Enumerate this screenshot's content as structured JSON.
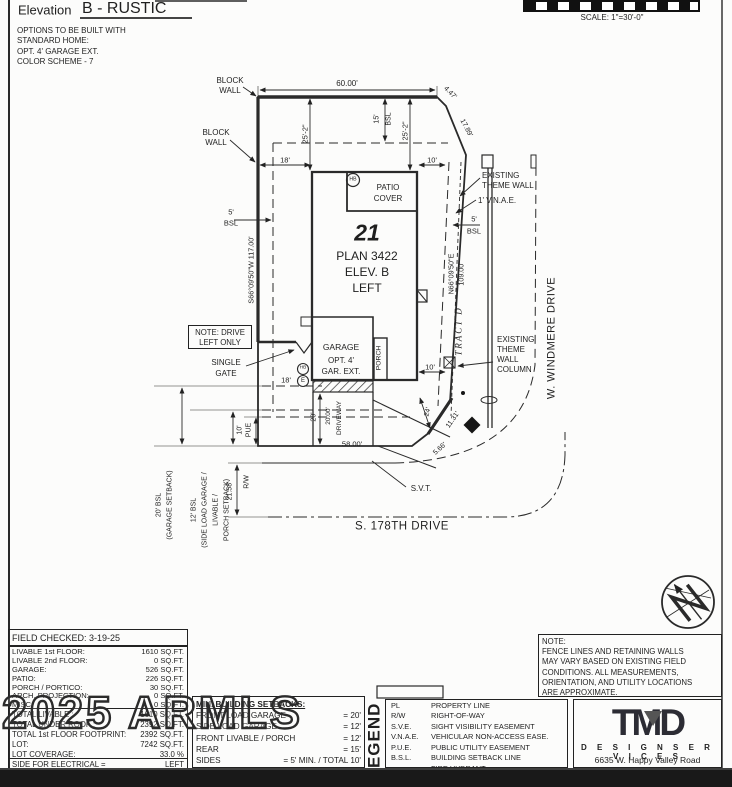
{
  "header": {
    "elevation_label": "Elevation",
    "elevation_value": "B - RUSTIC",
    "options": [
      "OPTIONS TO BE BUILT WITH",
      "STANDARD HOME:",
      "OPT. 4' GARAGE EXT.",
      "COLOR SCHEME - 7"
    ],
    "scale": "SCALE:  1\"=30'-0\""
  },
  "plan": {
    "block_wall_top": [
      "BLOCK",
      "WALL"
    ],
    "block_wall_left": [
      "BLOCK",
      "WALL"
    ],
    "dim_60": "60.00'",
    "dim_447": "4.47'",
    "dim_1789": "17.89'",
    "dim_252_left": "25'-2\"",
    "dim_252_right": "25'-2\"",
    "dim_15": "15'",
    "bsl_15": "BSL",
    "dim_18_top": "18'",
    "dim_10_top": "10'",
    "existing_theme_wall": [
      "EXISTING",
      "THEME WALL"
    ],
    "vnae": "1' V.N.A.E.",
    "dim_5_right": "5'",
    "bsl_right": "BSL",
    "bearing_right": "N66°09'50\"E",
    "dim_109": "109.00'",
    "tract_d": "TRACT  D",
    "bearing_left": "S66°09'50\"W  117.00'",
    "dim_5_left": "5'",
    "bsl_left": "BSL",
    "lot_number": "21",
    "plan_name": "PLAN 3422",
    "elev": "ELEV. B",
    "side": "LEFT",
    "patio_cover": [
      "PATIO",
      "COVER"
    ],
    "hb": "HB",
    "e": "E",
    "garage": "GARAGE",
    "garage_opt1": "OPT. 4'",
    "garage_opt2": "GAR. EXT.",
    "porch": "PORCH",
    "note_drive": [
      "NOTE: DRIVE",
      "LEFT ONLY"
    ],
    "single_gate": [
      "SINGLE",
      "GATE"
    ],
    "dim_18_gate": "18'",
    "theme_wall_column": [
      "EXISTING",
      "THEME",
      "WALL",
      "COLUMN"
    ],
    "dim_10_column": "10'",
    "windmere": "W. WINDMERE DRIVE",
    "dim_20": "20'",
    "dim_2000": "20.00'",
    "driveway": "DRIVEWAY",
    "dim_58": "58.00'",
    "dim_24": "24'",
    "dim_1131": "11.31'",
    "dim_566": "5.66'",
    "svt": "S.V.T.",
    "dim_10_pue": "10'",
    "pue": "PUE",
    "dim_2158": "21.58'",
    "rw": "R/W",
    "setback_20": [
      "20' BSL",
      "(GARAGE SETBACK)"
    ],
    "setback_12": [
      "12' BSL",
      "(SIDE LOAD GARAGE /",
      "LIVABLE /",
      "PORCH SETBACK)"
    ],
    "street": "S. 178TH DRIVE"
  },
  "areas": {
    "field_checked": "FIELD CHECKED:  3-19-25",
    "rows": [
      {
        "label": "LIVABLE 1st FLOOR:",
        "value": "1610 SQ.FT."
      },
      {
        "label": "LIVABLE 2nd FLOOR:",
        "value": "0 SQ.FT."
      },
      {
        "label": "GARAGE:",
        "value": "526 SQ.FT."
      },
      {
        "label": "PATIO:",
        "value": "226 SQ.FT."
      },
      {
        "label": "PORCH / PORTICO:",
        "value": "30 SQ.FT."
      },
      {
        "label": "ARCH. PROJECTION:",
        "value": "0 SQ.FT."
      },
      {
        "label": "MISC:",
        "value": "0 SQ.FT."
      }
    ],
    "totals": [
      {
        "label": "TOTAL LIVABLE :",
        "value": "1610 SQ.FT."
      },
      {
        "label": "TOTAL UNDER ROOF :",
        "value": "2392 SQ.FT."
      },
      {
        "label": "TOTAL 1st FLOOR FOOTPRINT:",
        "value": "2392 SQ.FT."
      },
      {
        "label": "LOT:",
        "value": "7242 SQ.FT."
      },
      {
        "label": "LOT COVERAGE:",
        "value": "33.0 %"
      }
    ],
    "electrical": {
      "label": "SIDE FOR ELECTRICAL =",
      "value": "LEFT"
    }
  },
  "setbacks": {
    "title": "MIN. BUILDING SETBACKS:",
    "rows": [
      {
        "label": "FRONT LOAD GARAGE",
        "value": "= 20'"
      },
      {
        "label": "SIDE LOAD GARAGE",
        "value": "= 12'"
      },
      {
        "label": "FRONT LIVABLE / PORCH",
        "value": "= 12'"
      },
      {
        "label": "REAR",
        "value": "= 15'"
      },
      {
        "label": "SIDES",
        "value": "= 5' MIN. / TOTAL 10'"
      }
    ]
  },
  "legend": {
    "title": "LEGEND",
    "rows": [
      {
        "symbol": "PL",
        "desc": "PROPERTY LINE"
      },
      {
        "symbol": "R/W",
        "desc": "RIGHT-OF-WAY"
      },
      {
        "symbol": "S.V.E.",
        "desc": "SIGHT VISIBILITY EASEMENT"
      },
      {
        "symbol": "V.N.A.E.",
        "desc": "VEHICULAR NON-ACCESS EASE."
      },
      {
        "symbol": "P.U.E.",
        "desc": "PUBLIC UTILITY EASEMENT"
      },
      {
        "symbol": "B.S.L.",
        "desc": "BUILDING SETBACK LINE"
      },
      {
        "symbol": "●",
        "desc": "FIRE HYDRANT"
      }
    ]
  },
  "note": {
    "lines": [
      "NOTE:",
      "FENCE LINES AND RETAINING WALLS",
      "MAY VARY BASED ON EXISTING FIELD",
      "CONDITIONS.  ALL MEASUREMENTS,",
      "ORIENTATION, AND UTILITY LOCATIONS",
      "ARE APPROXIMATE."
    ]
  },
  "firm": {
    "logo": "TMD",
    "name": "D E S I G N   S E R V I C E S",
    "address": "6635 W. Happy Valley Road"
  },
  "watermark": "2025 ARMLS"
}
